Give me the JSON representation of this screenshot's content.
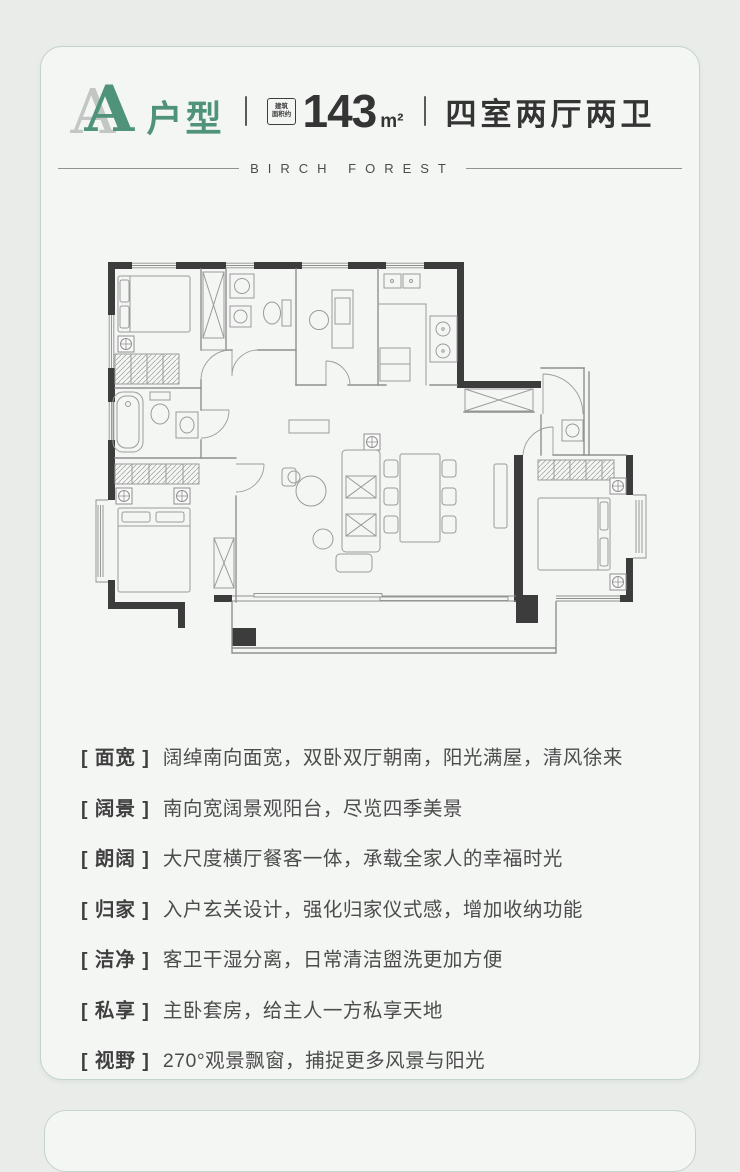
{
  "header": {
    "unit_letter": "A",
    "unit_suffix": "户型",
    "area_badge_line1": "建筑",
    "area_badge_line2": "面积约",
    "area_value": "143",
    "area_unit": "m²",
    "rooms_label": "四室两厅两卫"
  },
  "brand": {
    "name": "BIRCH FOREST"
  },
  "floorplan": {
    "kind": "4-bedroom 2-living 2-bath apartment plan, no text labels"
  },
  "features": [
    {
      "label": "[ 面宽 ]",
      "desc": "阔绰南向面宽，双卧双厅朝南，阳光满屋，清风徐来"
    },
    {
      "label": "[ 阔景 ]",
      "desc": "南向宽阔景观阳台，尽览四季美景"
    },
    {
      "label": "[ 朗阔 ]",
      "desc": "大尺度横厅餐客一体，承载全家人的幸福时光"
    },
    {
      "label": "[ 归家 ]",
      "desc": "入户玄关设计，强化归家仪式感，增加收纳功能"
    },
    {
      "label": "[ 洁净 ]",
      "desc": "客卫干湿分离，日常清洁盥洗更加方便"
    },
    {
      "label": "[ 私享 ]",
      "desc": "主卧套房，给主人一方私享天地"
    },
    {
      "label": "[ 视野 ]",
      "desc": "270°观景飘窗，捕捉更多风景与阳光"
    }
  ],
  "colors": {
    "accent_green": "#4f937a",
    "ink": "#343434",
    "wall_dark": "#3c3c3c",
    "card_border": "#c3d4cb",
    "page_bg": "#e9ece9",
    "card_bg": "#f4f6f4"
  }
}
